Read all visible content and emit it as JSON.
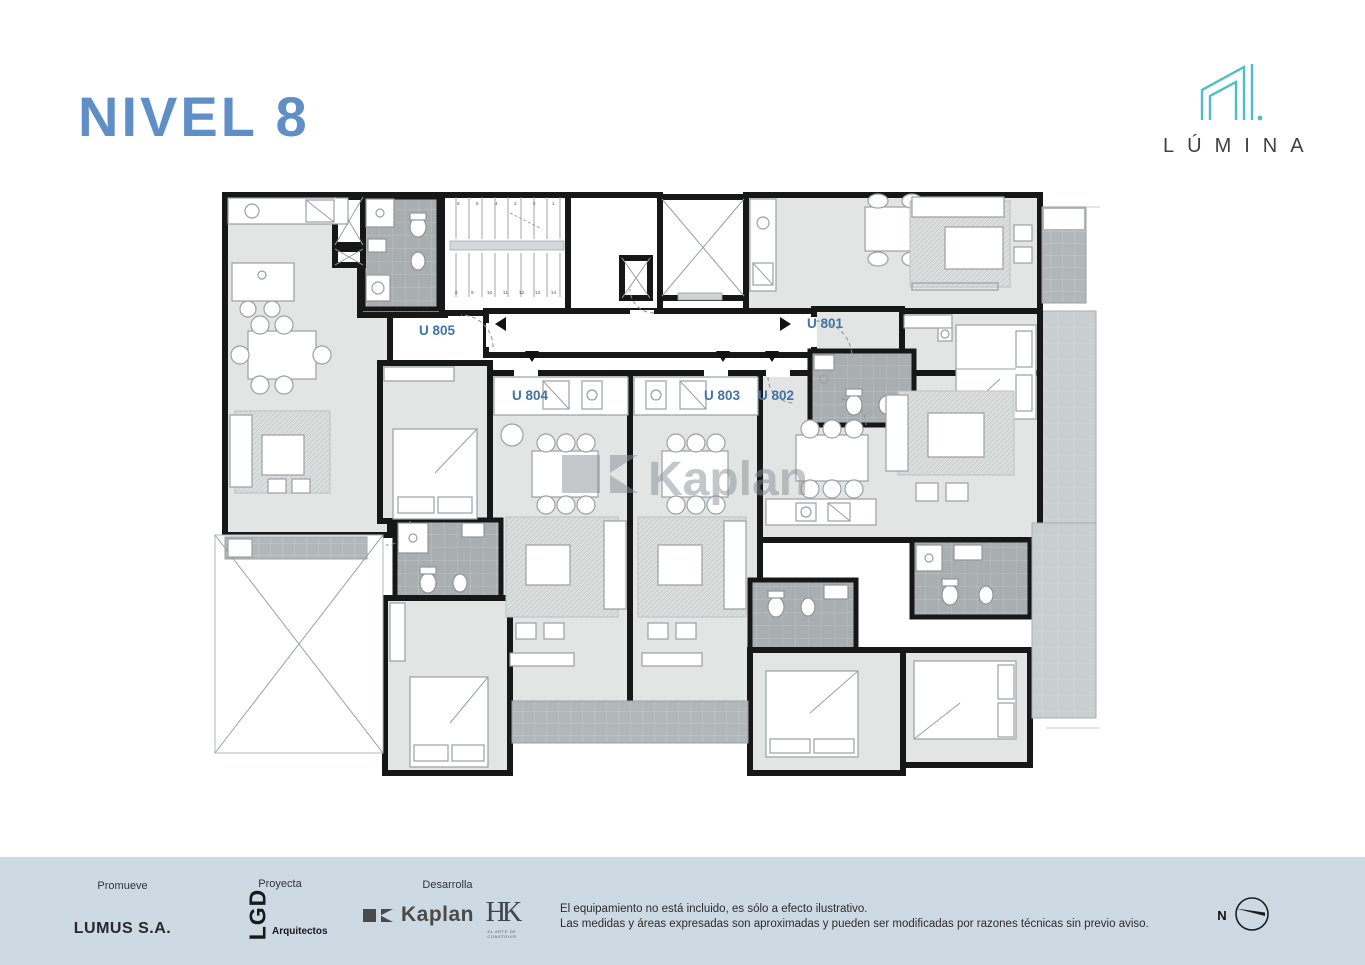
{
  "title": "NIVEL 8",
  "brand": {
    "name": "LÚMINA"
  },
  "plan": {
    "units": [
      {
        "id": "U 805"
      },
      {
        "id": "U 804"
      },
      {
        "id": "U 803"
      },
      {
        "id": "U 802"
      },
      {
        "id": "U 801"
      }
    ],
    "watermark": "Kaplan",
    "stairs": {
      "top": [
        "6",
        "5",
        "4",
        "3",
        "2",
        "1"
      ],
      "bottom": [
        "8",
        "9",
        "10",
        "11",
        "12",
        "13",
        "14"
      ]
    }
  },
  "footer": {
    "promueve_label": "Promueve",
    "promueve_name": "LUMUS S.A.",
    "proyecta_label": "Proyecta",
    "proyecta_name": "LGD",
    "proyecta_sub": "Arquitectos",
    "desarrolla_label": "Desarrolla",
    "desarrolla_name": "Kaplan",
    "hk_name": "HK",
    "hk_tagline": "EL ARTE DE CONSTRUIR",
    "disclaimer_line1": "El equipamiento no está incluido, es sólo a efecto ilustrativo.",
    "disclaimer_line2": "Las medidas y áreas expresadas son aproximadas y pueden ser modificadas por razones técnicas sin previo aviso.",
    "north_label": "N"
  },
  "colors": {
    "title_blue": "#5f8fc6",
    "unit_label_blue": "#4273a8",
    "brand_teal": "#4bbfc6",
    "footer_bg": "#cdd9e3",
    "wall_black": "#171717"
  }
}
